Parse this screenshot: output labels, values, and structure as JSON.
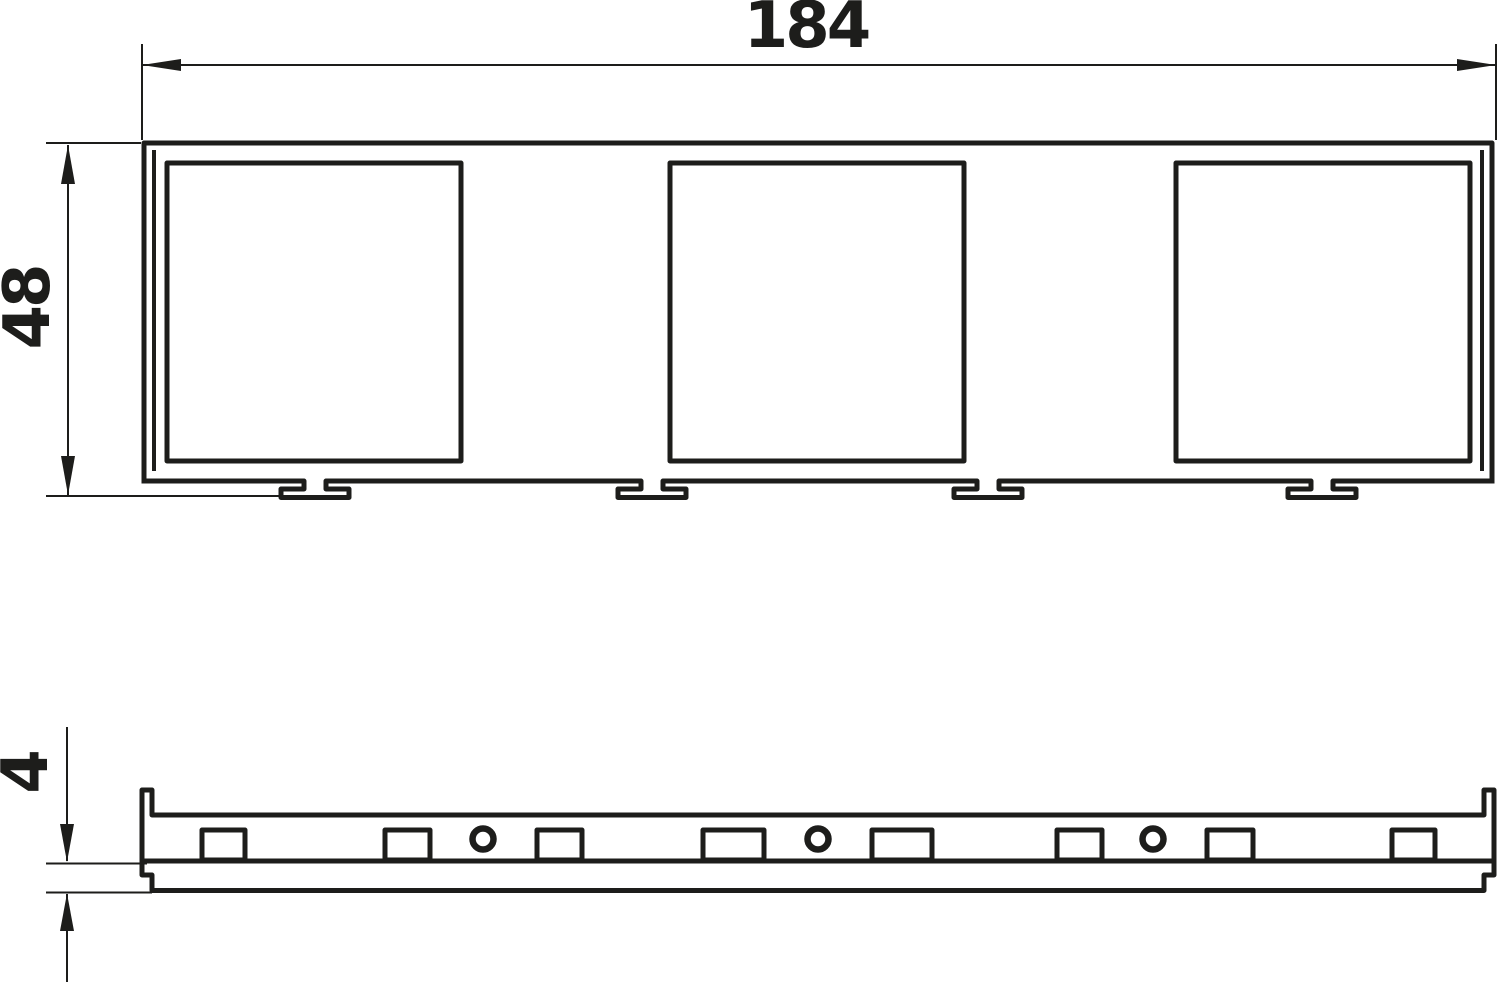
{
  "drawing": {
    "kind": "dimensioned technical drawing, front view and side view of a 3-gang mounting frame",
    "background_color": "#ffffff",
    "line_color": "#1d1d1b",
    "dimensions": {
      "width": "184",
      "height": "48",
      "thickness": "4"
    },
    "front_view": {
      "square_openings": 3,
      "mounting_feet": 4
    },
    "side_view": {
      "rectangular_slots": 8,
      "round_holes": 3
    }
  }
}
